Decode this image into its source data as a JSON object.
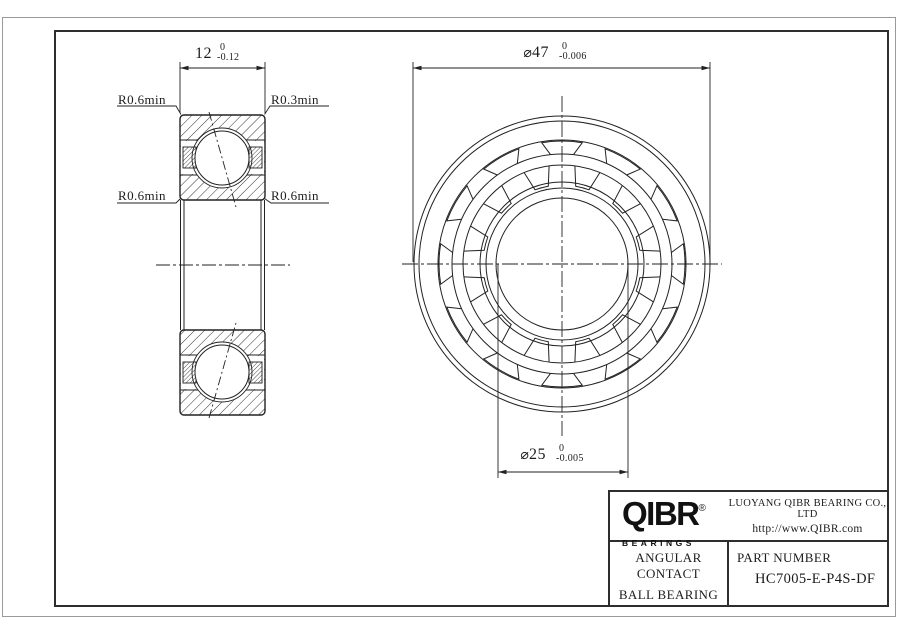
{
  "drawing": {
    "side_view": {
      "dim_width": {
        "value": "12",
        "tol_upper": "0",
        "tol_lower": "-0.12"
      },
      "labels": {
        "top_left": "R0.6min",
        "top_right": "R0.3min",
        "mid_left": "R0.6min",
        "mid_right": "R0.6min"
      }
    },
    "front_view": {
      "dim_outer_diameter": {
        "symbol": "⌀",
        "value": "47",
        "tol_upper": "0",
        "tol_lower": "-0.006"
      },
      "dim_bore_diameter": {
        "symbol": "⌀",
        "value": "25",
        "tol_upper": "0",
        "tol_lower": "-0.005"
      }
    }
  },
  "title_block": {
    "logo": {
      "brand": "QIBR",
      "registered": "®",
      "subtitle": "BEARINGS"
    },
    "company": "LUOYANG QIBR BEARING CO., LTD",
    "website": "http://www.QIBR.com",
    "product_type_line1": "ANGULAR CONTACT",
    "product_type_line2": "BALL BEARING",
    "part_number_label": "PART NUMBER",
    "part_number": "HC7005-E-P4S-DF"
  },
  "colors": {
    "line": "#222222",
    "frame_outer": "#9a9a9a",
    "background": "#ffffff"
  }
}
